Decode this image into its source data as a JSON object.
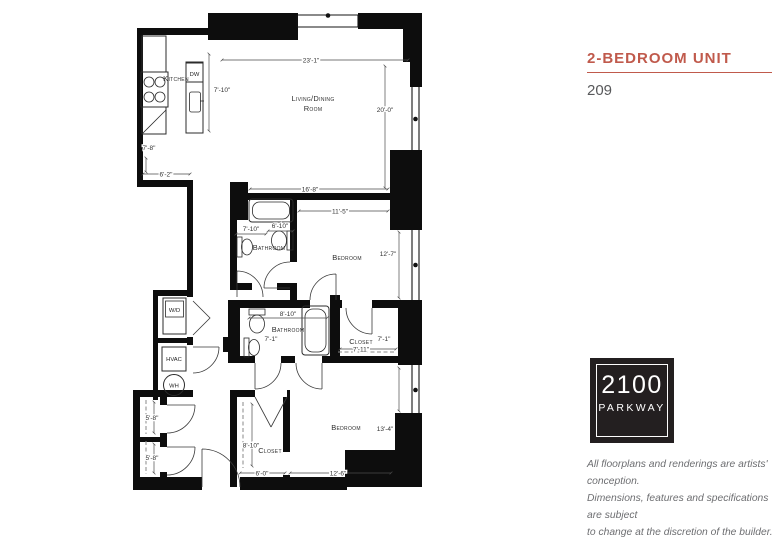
{
  "panel": {
    "title": "2-BEDROOM UNIT",
    "unit_number": "209",
    "accent_color": "#c05a4c",
    "logo": {
      "line1": "2100",
      "line2": "PARKWAY",
      "bg": "#231f20"
    },
    "disclaimer_line1": "All floorplans and renderings are artists' conception.",
    "disclaimer_line2": "Dimensions, features and specifications are subject",
    "disclaimer_line3": "to change at the discretion of the builder."
  },
  "floorplan": {
    "labels": {
      "kitchen": "Kitchen",
      "dw": "DW",
      "living_line1": "Living/Dining",
      "living_line2": "Room",
      "bathroom1": "Bathroom",
      "bedroom1": "Bedroom",
      "bathroom2": "Bathroom",
      "closet1": "Closet",
      "bedroom2": "Bedroom",
      "closet2": "Closet",
      "wd": "W/D",
      "hvac": "HVAC",
      "wh": "WH"
    },
    "dims": {
      "living_width": "23'-1\"",
      "living_height": "20'-0\"",
      "island_length": "7'-10\"",
      "kitchen_left": "7'-8\"",
      "kitchen_bottom": "6'-2\"",
      "upper_wall": "16'-8\"",
      "bedroom1_width": "11'-5\"",
      "bedroom1_height": "12'-7\"",
      "bathroom1_width": "7'-10\"",
      "bathroom1_inner": "6'-10\"",
      "bathroom2_width": "8'-10\"",
      "bathroom2_height": "7'-1\"",
      "closet1_height": "7'-1\"",
      "closet1_width": "7'-11\"",
      "bedroom2_height": "13'-4\"",
      "bedroom2_width": "12'-6\"",
      "hall_closet_a": "5'-8\"",
      "hall_closet_b": "5'-8\"",
      "closet2_height": "8'-10\"",
      "closet2_width": "6'-0\""
    }
  }
}
